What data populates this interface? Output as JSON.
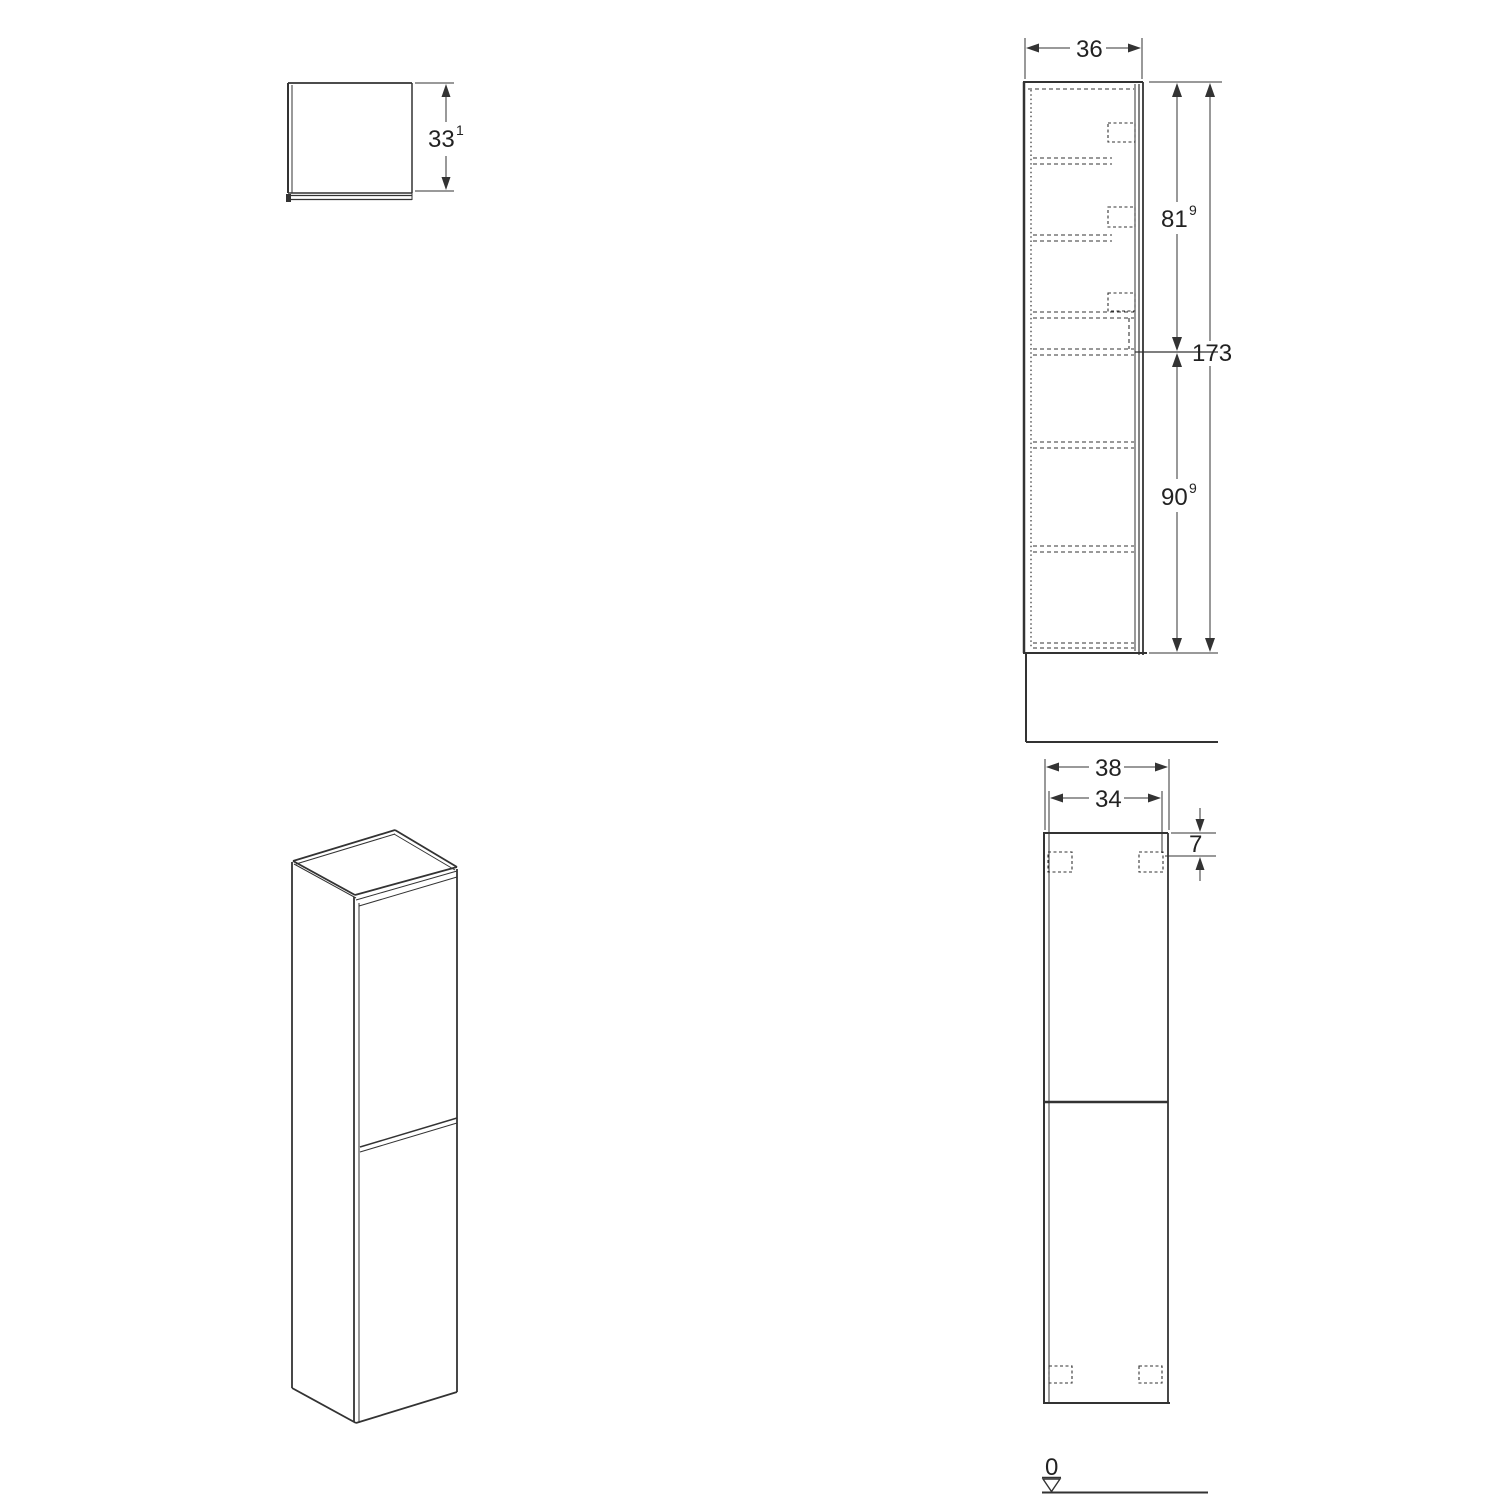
{
  "drawing": {
    "top_view": {
      "depth": {
        "value": "33",
        "sup": "1"
      }
    },
    "side_view": {
      "width": {
        "value": "36"
      },
      "upper_height": {
        "value": "81",
        "sup": "9"
      },
      "total_height": {
        "value": "173"
      },
      "lower_height": {
        "value": "90",
        "sup": "9"
      }
    },
    "front_view": {
      "outer_width": {
        "value": "38"
      },
      "inner_width": {
        "value": "34"
      },
      "bracket_offset": {
        "value": "7"
      },
      "floor_datum": {
        "value": "0"
      }
    }
  }
}
